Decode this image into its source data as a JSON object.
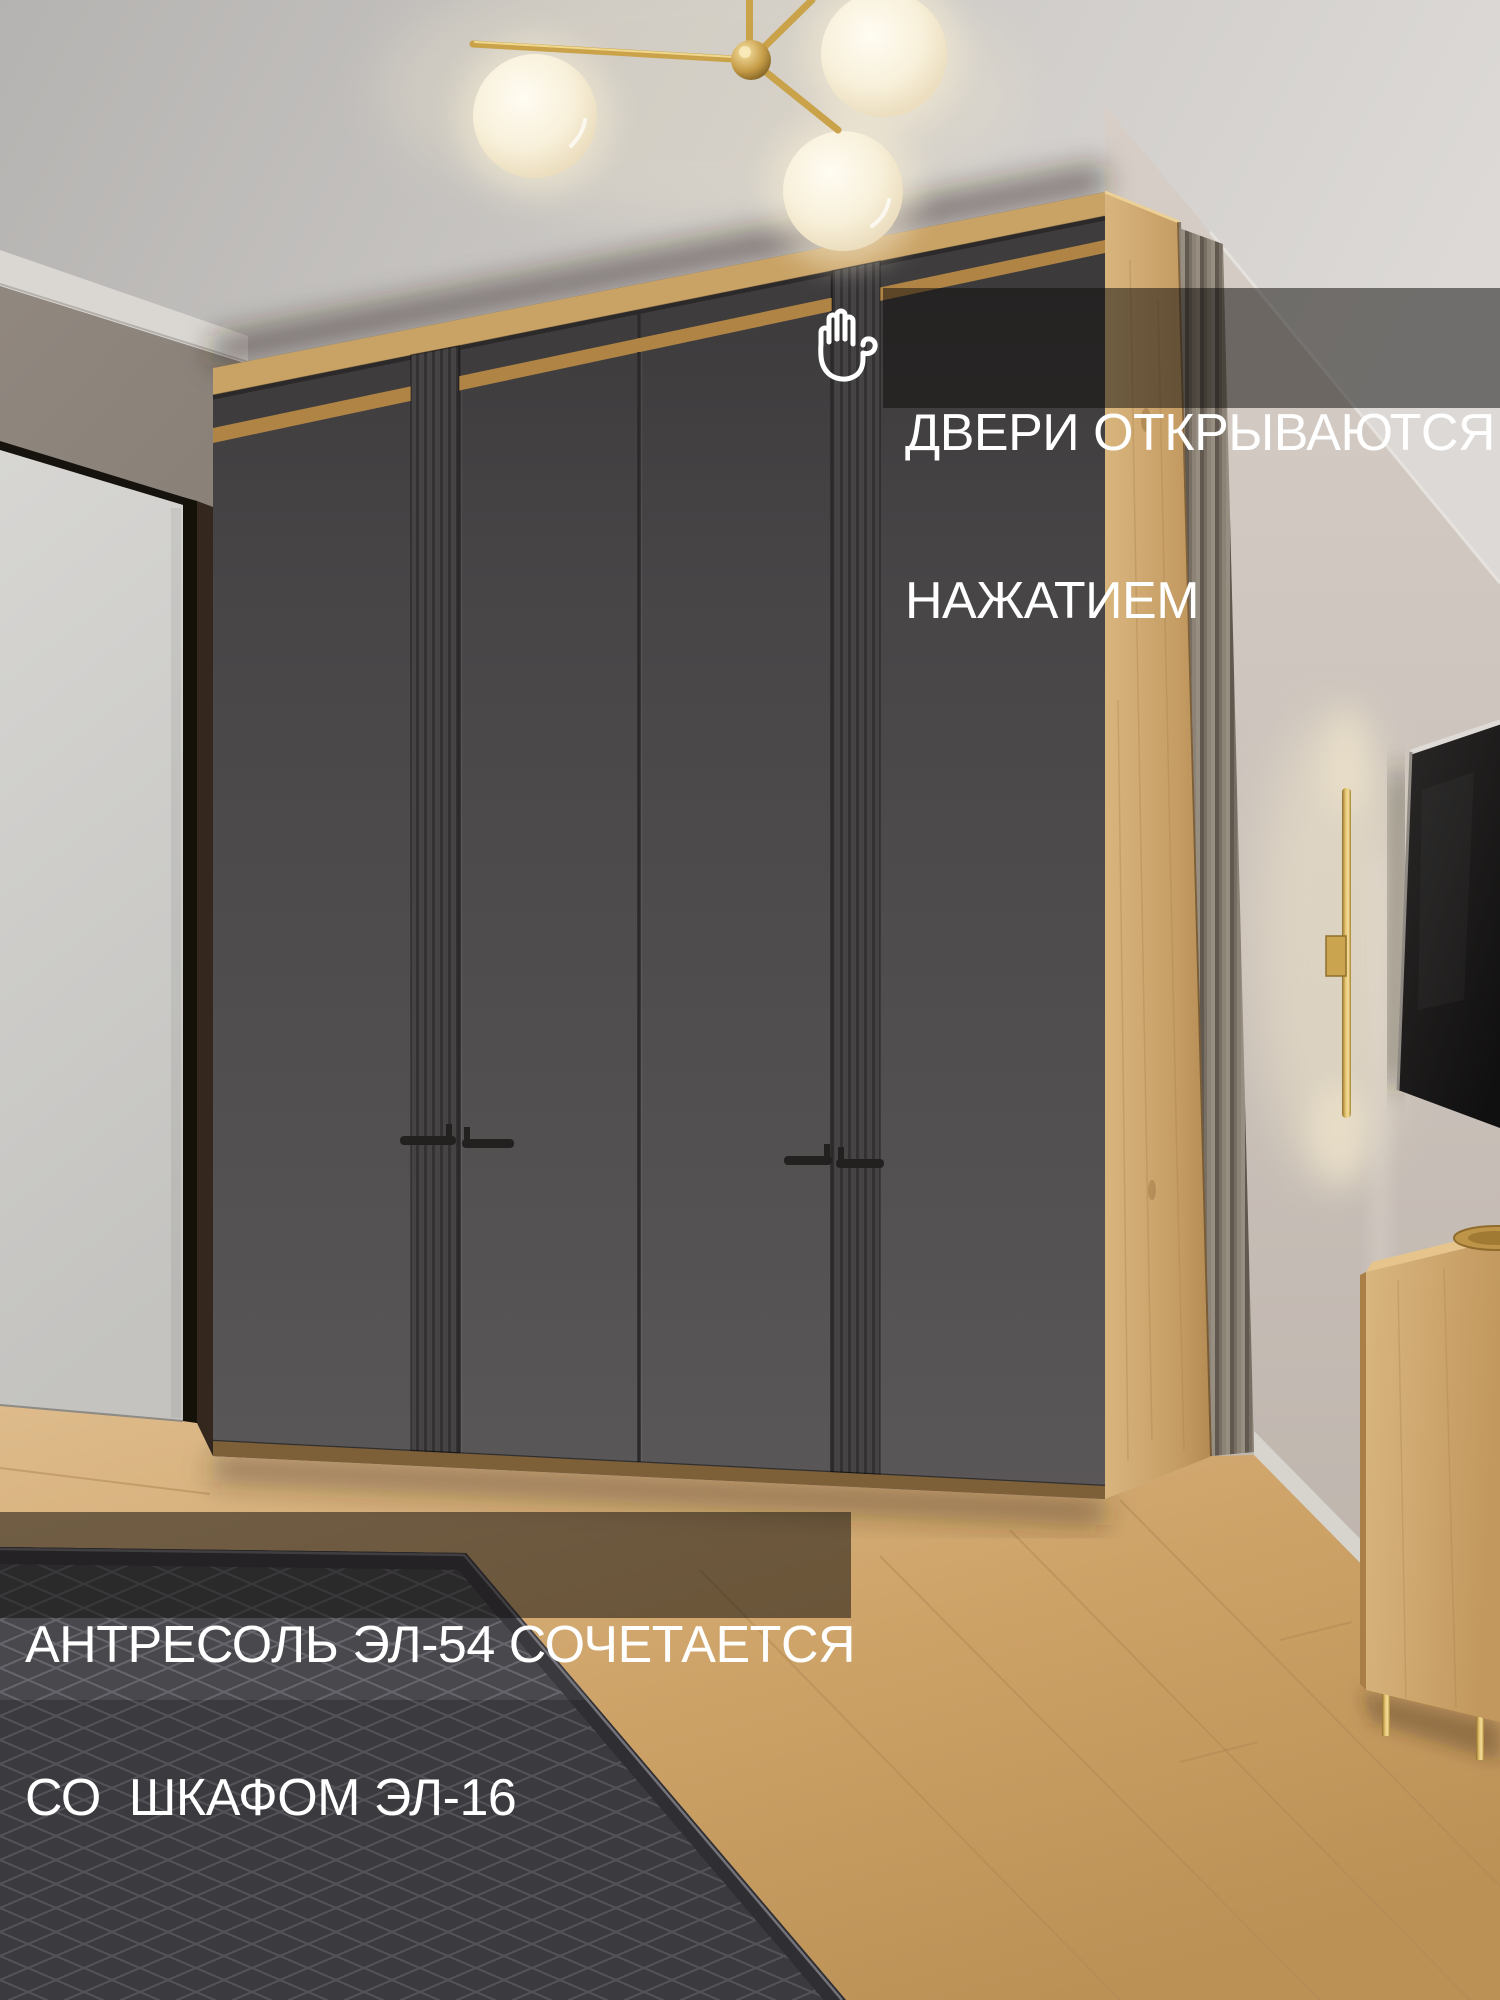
{
  "banners": {
    "doors_open": {
      "icon": "hand-press-icon",
      "line1": "ДВЕРИ ОТКРЫВАЮТСЯ",
      "line2": "НАЖАТИЕМ"
    },
    "combo": {
      "line1": "АНТРЕСОЛЬ ЭЛ-54 СОЧЕТАЕТСЯ",
      "line2": "СО  ШКАФОМ ЭЛ-16"
    }
  },
  "palette": {
    "overlay_scrim": "#110f0d",
    "text_white": "#ffffff",
    "oak": "#c9a265",
    "oak_divider": "#b08445",
    "oak_plinth": "#7d5f38",
    "graphite_door": "#4a4849",
    "handle_black": "#232120",
    "brass": "#caa44f",
    "wall_taupe": "#8a8178",
    "wall_right": "#cbc2bb",
    "ceiling": "#cfccc9",
    "floor_oak": "#cfa873",
    "rug_gray": "#49484d"
  },
  "scene": {
    "objects": [
      "ceiling-lamp",
      "wardrobe",
      "mezzanine",
      "white-door",
      "fluted-wall-panel",
      "tv",
      "wall-light-bar",
      "sideboard",
      "rug",
      "oak-floor"
    ]
  }
}
